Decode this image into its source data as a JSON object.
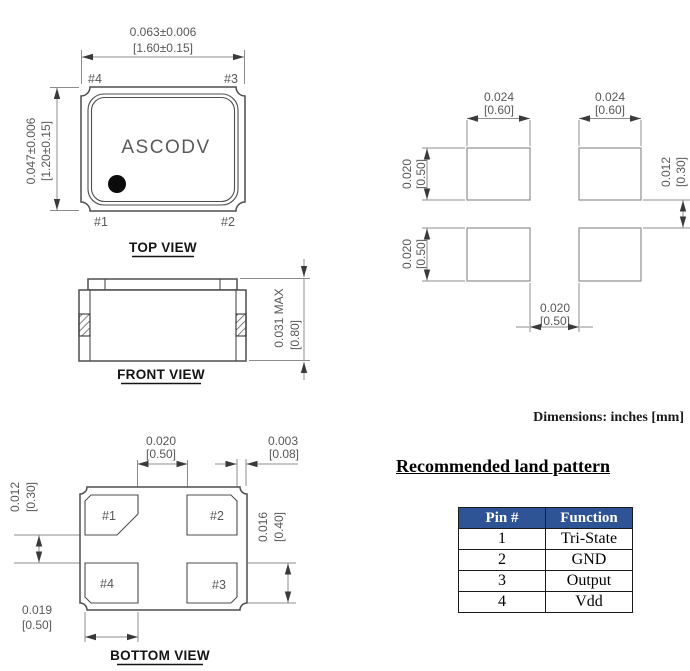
{
  "colors": {
    "table_header_bg": "#2f5496",
    "table_header_text": "#ffffff",
    "part_line": "#4d4d4d",
    "dimension_line": "#8c8c8c",
    "dimension_text": "#575757",
    "label_text": "#141414"
  },
  "top_view": {
    "title": "TOP VIEW",
    "marking": "ASCODV",
    "width_in": "0.063±0.006",
    "width_mm": "[1.60±0.15]",
    "height_in": "0.047±0.006",
    "height_mm": "[1.20±0.15]",
    "pin_top_left": "#4",
    "pin_top_right": "#3",
    "pin_bottom_left": "#1",
    "pin_bottom_right": "#2"
  },
  "front_view": {
    "title": "FRONT VIEW",
    "height_in": "0.031 MAX",
    "height_mm": "[0.80]"
  },
  "bottom_view": {
    "title": "BOTTOM VIEW",
    "pad_top_left": "#1",
    "pad_top_right": "#2",
    "pad_bottom_left": "#4",
    "pad_bottom_right": "#3",
    "pad_gap_in": "0.020",
    "pad_gap_mm": "[0.50]",
    "edge_gap_in": "0.003",
    "edge_gap_mm": "[0.08]",
    "row_gap_in": "0.012",
    "row_gap_mm": "[0.30]",
    "pad_height_in": "0.016",
    "pad_height_mm": "[0.40]",
    "pad_width_in": "0.019",
    "pad_width_mm": "[0.50]"
  },
  "land_pattern": {
    "pad_width_in": "0.024",
    "pad_width_mm": "[0.60]",
    "pad_height_in": "0.020",
    "pad_height_mm": "[0.50]",
    "row_gap_in": "0.012",
    "row_gap_mm": "[0.30]",
    "col_gap_in": "0.020",
    "col_gap_mm": "[0.50]"
  },
  "notes": {
    "units": "Dimensions: inches [mm]"
  },
  "section": {
    "heading": "Recommended land pattern"
  },
  "pin_table": {
    "headers": [
      "Pin #",
      "Function"
    ],
    "rows": [
      {
        "pin": "1",
        "function": "Tri-State"
      },
      {
        "pin": "2",
        "function": "GND"
      },
      {
        "pin": "3",
        "function": "Output"
      },
      {
        "pin": "4",
        "function": "Vdd"
      }
    ]
  }
}
